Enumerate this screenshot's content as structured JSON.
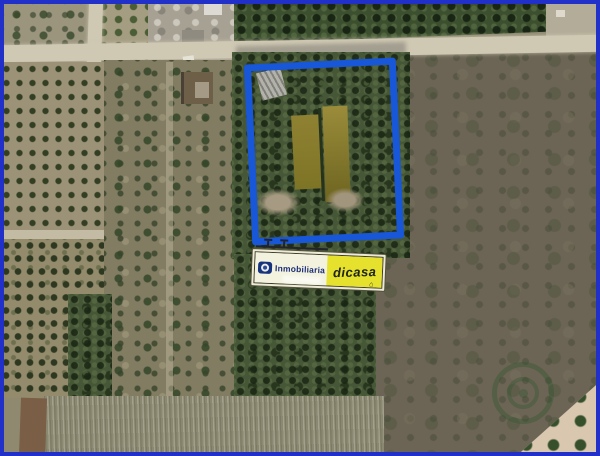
{
  "scene": {
    "description": "Aerial satellite view of rural farm parcels; one plot outlined in blue with a realtor sign overlay"
  },
  "frame": {
    "border_color": "#2130c8"
  },
  "highlight": {
    "outline_color": "#1757d8",
    "shape": "rectangle"
  },
  "sign": {
    "brand_primary": "Inmobiliaria",
    "brand_secondary": "dicasa",
    "house_mark": "⌂",
    "panel_color": "#f2f2df",
    "accent_color": "#e5e12d",
    "text_color": "#1c2e78",
    "logo_icon": "globe-icon"
  },
  "watermark": {
    "icon": "circular-stamp-icon",
    "color": "#2a5e2e"
  }
}
